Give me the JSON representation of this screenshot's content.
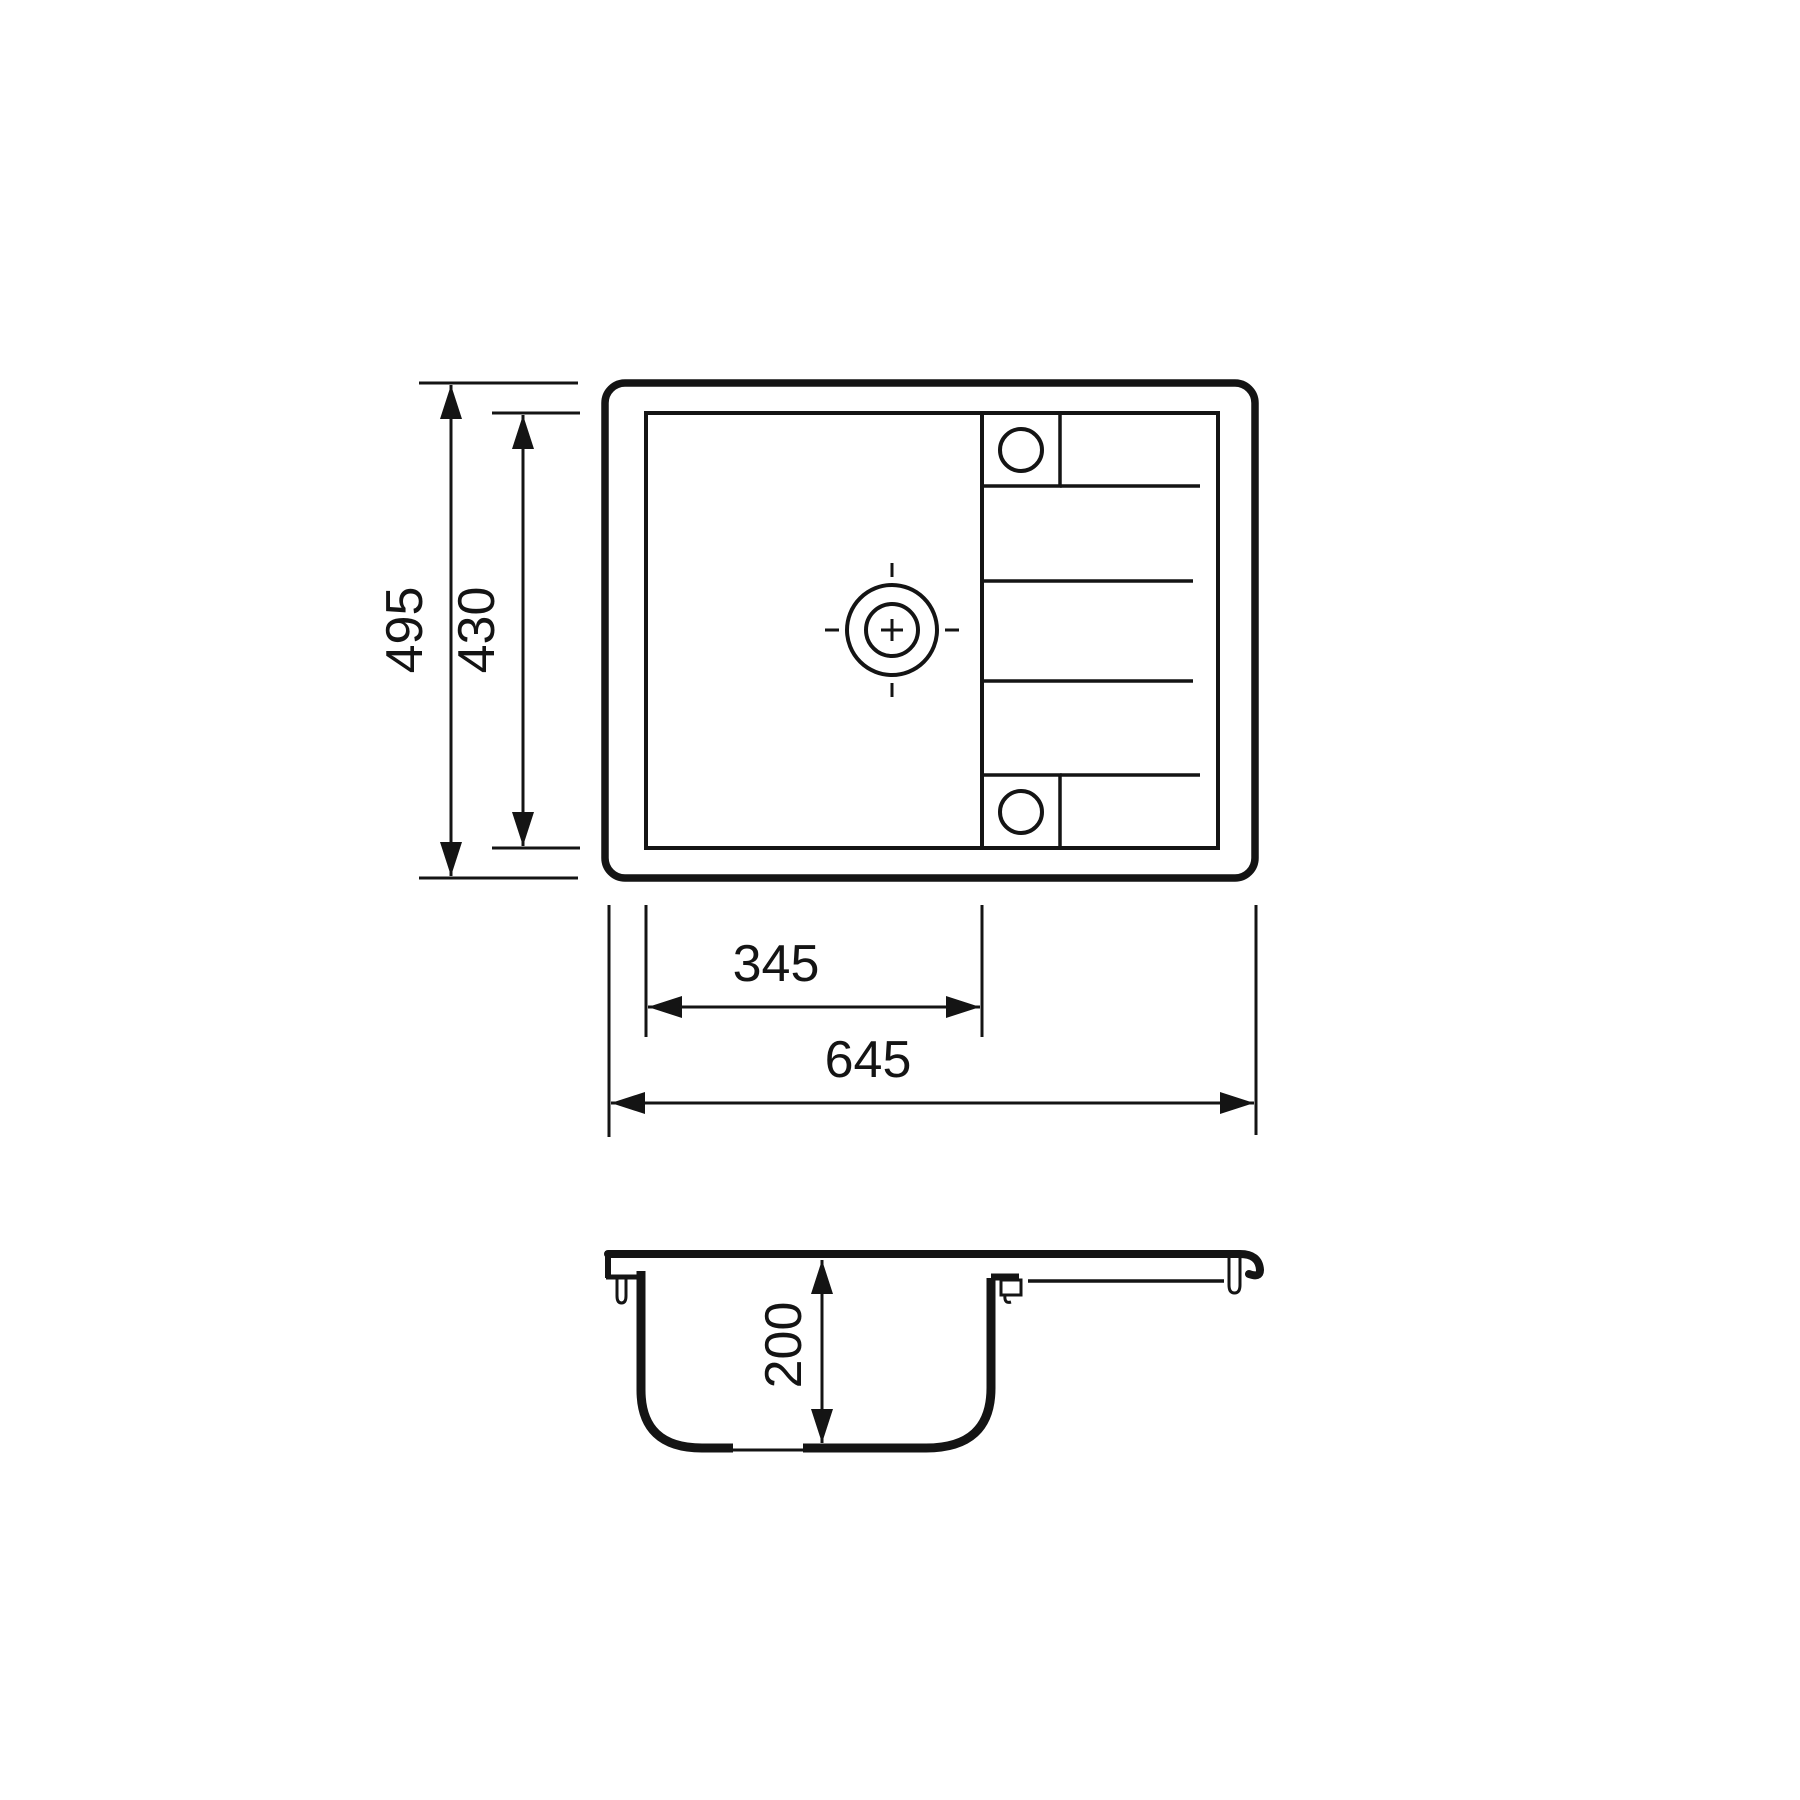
{
  "drawing": {
    "colors": {
      "line": "#141414",
      "background": "#ffffff"
    },
    "dimensions": {
      "overall_depth": "495",
      "inner_depth": "430",
      "bowl_width": "345",
      "overall_width": "645",
      "bowl_depth": "200"
    }
  }
}
